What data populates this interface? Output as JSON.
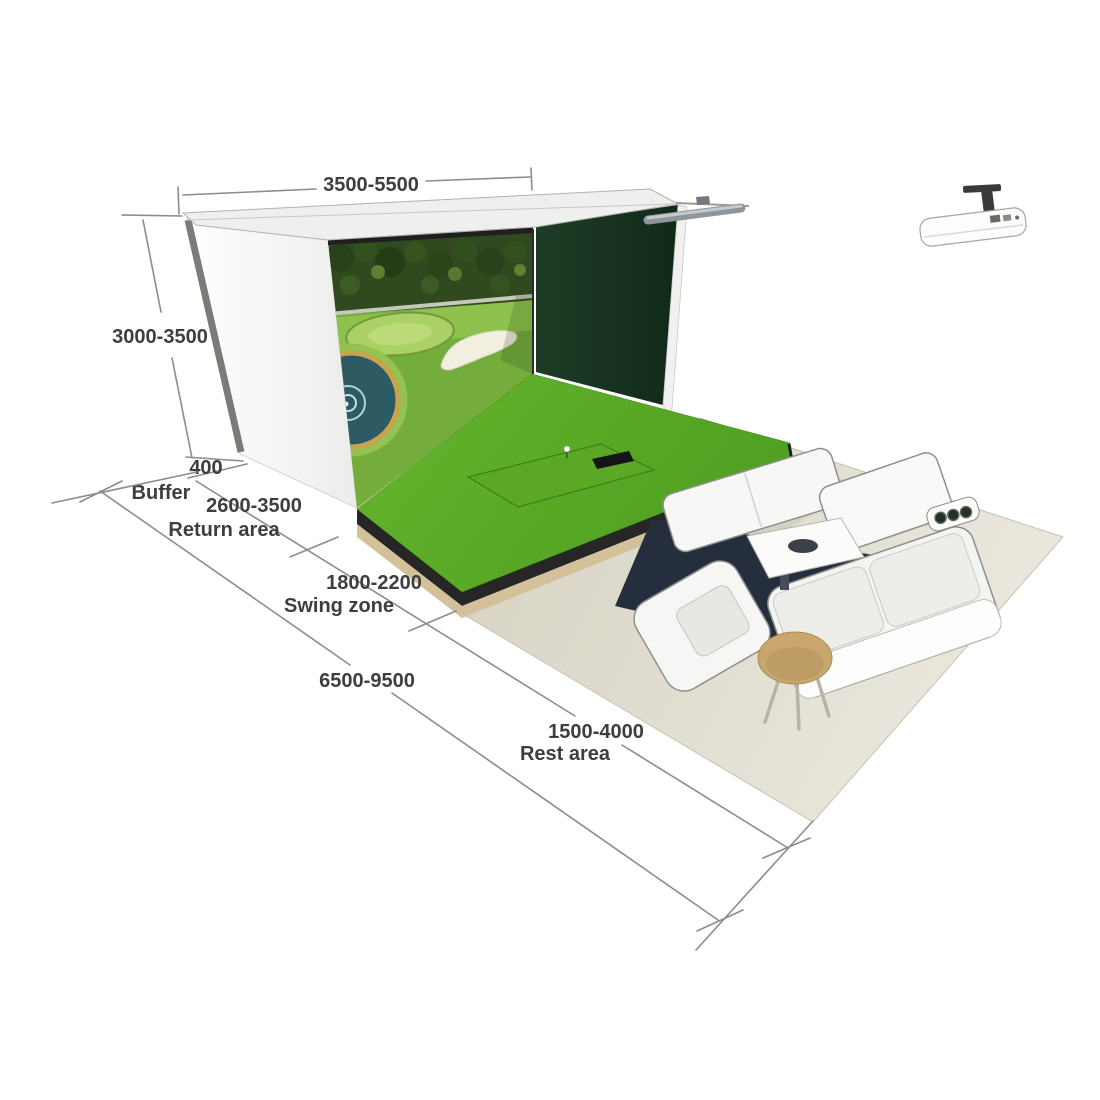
{
  "page": {
    "background": "#ffffff",
    "description": "Golf simulator room layout diagram with dimension annotations (mm)"
  },
  "dimensions": {
    "enclosure_width": {
      "value": "3500-5500"
    },
    "enclosure_height": {
      "value": "3000-3500"
    },
    "buffer": {
      "value": "400",
      "label": "Buffer"
    },
    "return_area": {
      "value": "2600-3500",
      "label": "Return area"
    },
    "swing_zone": {
      "value": "1800-2200",
      "label": "Swing zone"
    },
    "room_depth": {
      "value": "6500-9500"
    },
    "rest_area": {
      "value": "1500-4000",
      "label": "Rest area"
    }
  },
  "colors": {
    "turf": "#5fae2a",
    "turf_dark": "#4fa021",
    "impact_wall": "#16331f",
    "floor": "#ddd9cb",
    "rug": "#252e3c",
    "side_table": "#c9a76c",
    "platform_base": "#d2c199",
    "dimension_line": "#8c8c8c",
    "dimension_text": "#3e3e3e"
  }
}
